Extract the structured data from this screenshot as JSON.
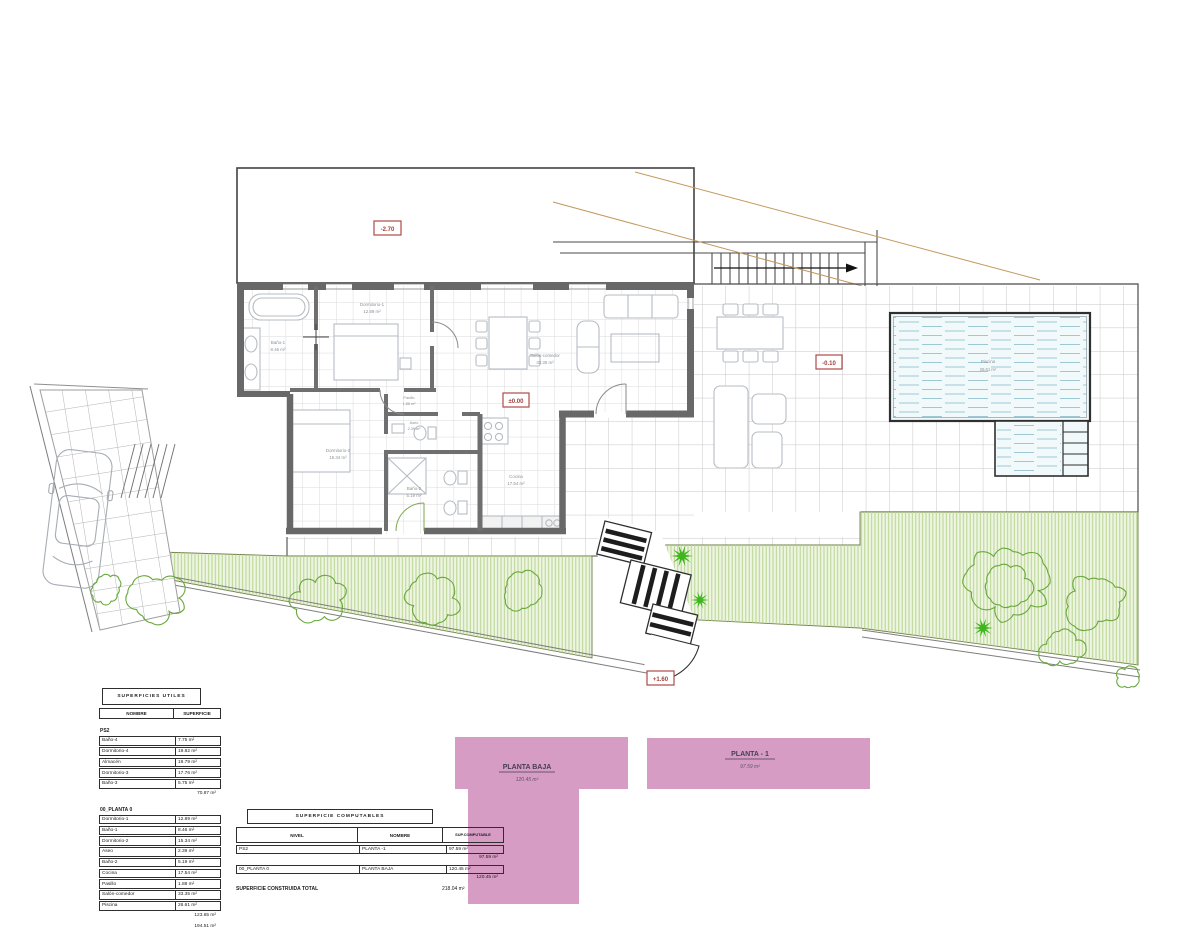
{
  "plan": {
    "level_markers": {
      "upper": "-2.70",
      "main": "±0.00",
      "terrace": "-0.10",
      "garden": "+1.60"
    },
    "rooms": {
      "banyo1": {
        "name": "Baño-1",
        "area": "8.46 m²"
      },
      "dormitorio1": {
        "name": "Dormitorio-1",
        "area": "12.89 m²"
      },
      "dormitorio2": {
        "name": "Dormitorio-2",
        "area": "15.34 m²"
      },
      "pasillo": {
        "name": "Pasillo",
        "area": "1.88 m²"
      },
      "aseo": {
        "name": "Aseo",
        "area": "2.39 m²"
      },
      "banyo2": {
        "name": "Baño-2",
        "area": "5.19 m²"
      },
      "cocina": {
        "name": "Cocina",
        "area": "17.54 m²"
      },
      "salon": {
        "name": "Salón-comedor",
        "area": "33.35 m²"
      },
      "piscina": {
        "name": "Piscina",
        "area": "26.61 m²"
      }
    },
    "floor_tags": {
      "planta_baja": {
        "name": "PLANTA BAJA",
        "area": "120.45 m²"
      },
      "planta_menos_1": {
        "name": "PLANTA - 1",
        "area": "97.59 m²"
      }
    }
  },
  "tables": {
    "utiles": {
      "title": "SUPERFICIES UTILES",
      "columns": [
        "NOMBRE",
        "SUPERFICIE"
      ],
      "sections": [
        {
          "name": "PS2",
          "rows": [
            [
              "Baño-4",
              "7.75 m²"
            ],
            [
              "Dormitorio-4",
              "19.82 m²"
            ],
            [
              "Almacén",
              "19.79 m²"
            ],
            [
              "Dormitorio-3",
              "17.76 m²"
            ],
            [
              "Baño-3",
              "5.75 m²"
            ]
          ],
          "subtotal": "70.87 m²"
        },
        {
          "name": "00_PLANTA 0",
          "rows": [
            [
              "Dormitorio-1",
              "12.89 m²"
            ],
            [
              "Baño-1",
              "8.46 m²"
            ],
            [
              "Dormitorio-2",
              "15.34 m²"
            ],
            [
              "Aseo",
              "2.39 m²"
            ],
            [
              "Baño-2",
              "5.19 m²"
            ],
            [
              "Cocina",
              "17.54 m²"
            ],
            [
              "Pasillo",
              "1.88 m²"
            ],
            [
              "Salón-comedor",
              "33.35 m²"
            ],
            [
              "Piscina",
              "26.61 m²"
            ]
          ],
          "subtotal": "123.65 m²",
          "grand_total": "194.51 m²"
        }
      ]
    },
    "computables": {
      "title": "SUPERFICIE COMPUTABLES",
      "columns": [
        "NIVEL",
        "NOMBRE",
        "SUP.COMPUTABLE"
      ],
      "rows": [
        {
          "nivel": "PS2",
          "nombre": "PLANTA -1",
          "sup": "97.59 m²",
          "subtotal": "97.59 m²"
        },
        {
          "nivel": "00_PLANTA 0",
          "nombre": "PLANTA BAJA",
          "sup": "120.45 m²",
          "subtotal": "120.45 m²"
        }
      ],
      "total_label": "SUPERFICIE CONSTRUIDA TOTAL",
      "total_value": "218.04 m²"
    }
  },
  "colors": {
    "wall": "#686868",
    "pink": "#d69cc3",
    "garden_fill": "#eef5e2",
    "garden_hatch": "#b7d48d",
    "tree_line": "#69a83c",
    "plant_green": "#3fb61e",
    "pool_fill": "#f2f9fb",
    "pool_hatch": "#9ec7d6",
    "topo_line": "#c3985e",
    "level_red": "#b04a47"
  }
}
